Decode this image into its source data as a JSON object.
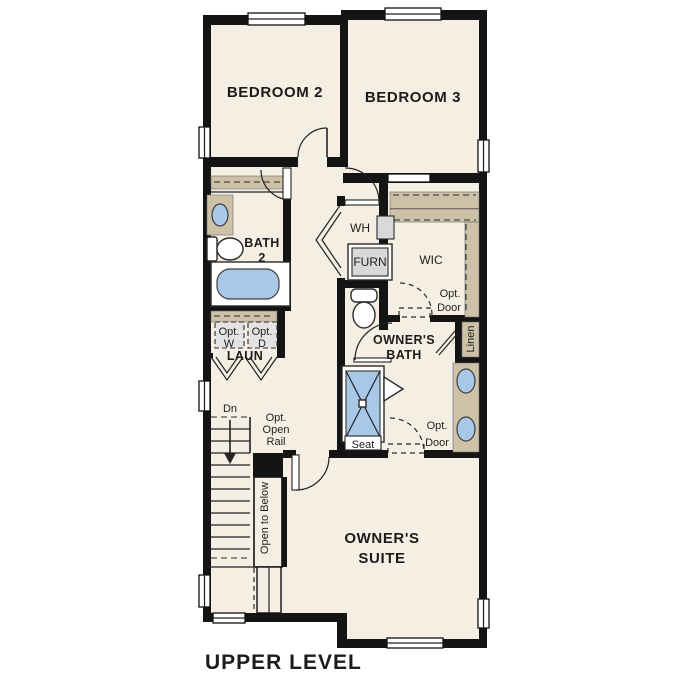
{
  "floor_plan": {
    "title": "UPPER LEVEL",
    "rooms": {
      "bedroom_2": "BEDROOM 2",
      "bedroom_3": "BEDROOM 3",
      "bath_2": [
        "BATH",
        "2"
      ],
      "laundry": "LAUN",
      "owners_bath": [
        "OWNER'S",
        "BATH"
      ],
      "owners_suite": [
        "OWNER'S",
        "SUITE"
      ],
      "wic": "WIC",
      "linen": "Linen"
    },
    "labels": {
      "water_heater": "WH",
      "furnace": "FURN",
      "opt_washer": [
        "Opt.",
        "W"
      ],
      "opt_dryer": [
        "Opt.",
        "D"
      ],
      "wic_opt_door": [
        "Opt.",
        "Door"
      ],
      "suite_opt_door": [
        "Opt.",
        "Door"
      ],
      "shower_seat": "Seat",
      "stairs_down": "Dn",
      "opt_open_rail": [
        "Opt.",
        "Open",
        "Rail"
      ],
      "open_to_below": "Open to Below"
    },
    "colors": {
      "wall": "#141414",
      "floor": "#f5eee3",
      "closet_tan": "#cdc1a8",
      "fixture_blue": "#a9c8e7",
      "appliance_gray": "#d9d9d9",
      "optional_gray": "#e3e3e3",
      "background": "#ffffff"
    }
  }
}
